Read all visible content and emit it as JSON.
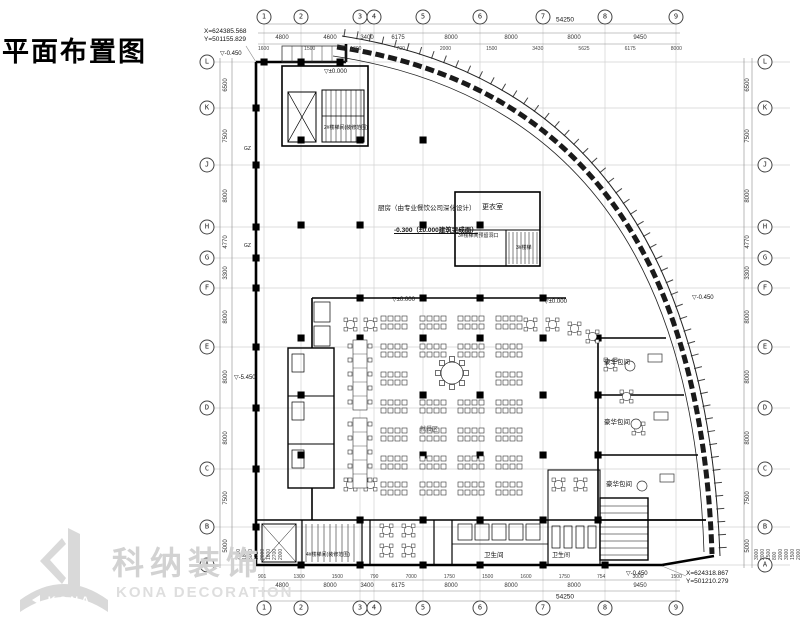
{
  "title": "平面布置图",
  "coordinates": {
    "top_left_x": "X=624385.568",
    "top_left_y": "Y=501155.829",
    "bottom_right_x": "X=624318.867",
    "bottom_right_y": "Y=501210.279"
  },
  "grid": {
    "top_bubbles": [
      "1",
      "2",
      "3",
      "4",
      "5",
      "6",
      "7",
      "8",
      "9"
    ],
    "bottom_bubbles": [
      "1",
      "2",
      "3",
      "4",
      "5",
      "6",
      "7",
      "8",
      "9"
    ],
    "left_bubbles": [
      "L",
      "K",
      "J",
      "H",
      "G",
      "F",
      "E",
      "D",
      "C",
      "B",
      "A"
    ],
    "right_bubbles": [
      "L",
      "K",
      "J",
      "H",
      "G",
      "F",
      "E",
      "D",
      "C",
      "B",
      "A"
    ],
    "top_dims": [
      "4800",
      "4600",
      "3400",
      "6175",
      "8000",
      "8000",
      "8000",
      "9450"
    ],
    "bottom_dims": [
      "4800",
      "8000",
      "3400",
      "6175",
      "8000",
      "8000",
      "8000",
      "9450"
    ],
    "side_dims": [
      "6500",
      "7500",
      "8000",
      "4770",
      "3300",
      "8000",
      "8000",
      "8000",
      "7500",
      "5000"
    ],
    "top_dims_small": [
      "1600",
      "1500",
      "1600",
      "700",
      "2000",
      "1500",
      "3430",
      "5625",
      "6175",
      "8000"
    ],
    "bottom_dims_small": [
      "901",
      "1300",
      "1500",
      "790",
      "7000",
      "1750",
      "1500",
      "1600",
      "1750",
      "754",
      "3000",
      "1500"
    ],
    "left_dims_small": [
      "2000",
      "1800",
      "3000",
      "675",
      "2000",
      "1800",
      "2700",
      "2000"
    ],
    "right_dims_small": [
      "3000",
      "2000",
      "1500",
      "800",
      "2000",
      "3000",
      "1500",
      "2000"
    ],
    "top_total": "54250",
    "bottom_total": "54250"
  },
  "labels": {
    "stair2": "2#楼梯间(装修范围)",
    "stair3_note": "3#楼梯间预留洞口",
    "stair3": "3#楼梯",
    "stair4": "4#楼梯间(装修范围)",
    "kitchen_note": "厨房（由专业餐饮公司深化设计）",
    "kitchen_level": "-0.300（±0.000建筑完成面）",
    "changing_room": "更衣室",
    "dining_area": "就餐区",
    "vip1": "豪华包间",
    "vip2": "豪华包间",
    "vip3": "豪华包间",
    "wc1": "卫生间",
    "wc2": "卫生间",
    "gz": "GZ"
  },
  "elevations": {
    "zero_a": "▽±0.000",
    "zero_b": "▽±0.000",
    "zero_c": "▽±0.000",
    "top_left": "▽-0.450",
    "left_mid": "▽-5.450",
    "right_mid": "▽-0.450",
    "bottom_right": "▽-0.450"
  },
  "logo": {
    "cn": "科纳装饰",
    "en": "KONA DECORATION",
    "mark": "KONA"
  }
}
